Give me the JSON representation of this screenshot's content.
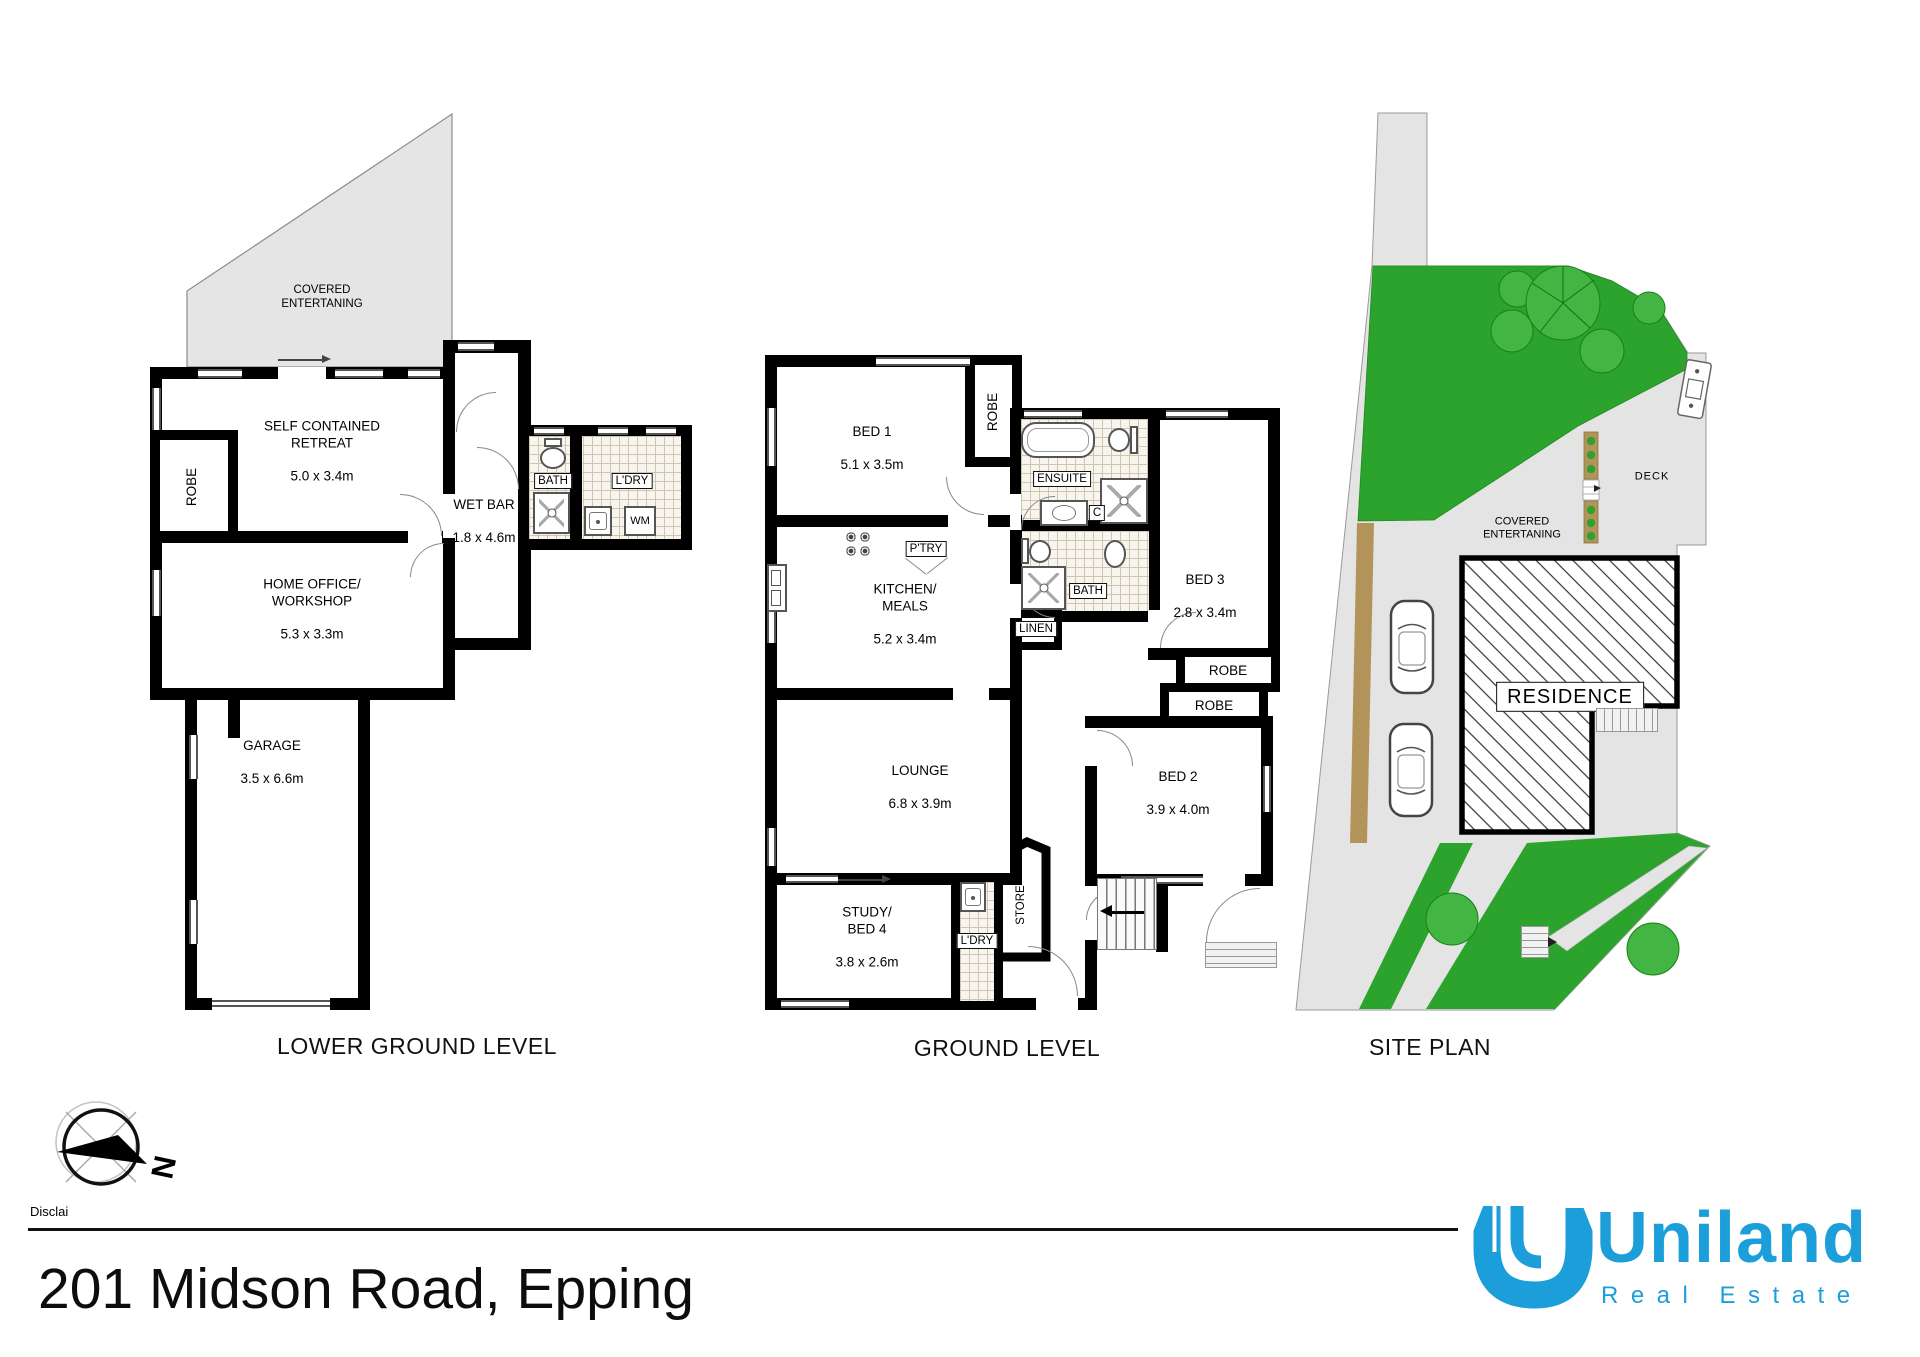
{
  "plans": {
    "lower": {
      "title": "LOWER GROUND LEVEL",
      "covered_entertaining": "COVERED\nENTERTANING",
      "rooms": {
        "retreat": {
          "name": "SELF CONTAINED\nRETREAT",
          "dims": "5.0 x 3.4m"
        },
        "wet_bar": {
          "name": "WET BAR",
          "dims": "1.8 x 4.6m"
        },
        "home_office": {
          "name": "HOME OFFICE/\nWORKSHOP",
          "dims": "5.3 x 3.3m"
        },
        "garage": {
          "name": "GARAGE",
          "dims": "3.5 x 6.6m"
        }
      },
      "labels": {
        "robe": "ROBE",
        "bath": "BATH",
        "laundry": "L'DRY",
        "washing_machine": "WM"
      }
    },
    "ground": {
      "title": "GROUND LEVEL",
      "rooms": {
        "bed1": {
          "name": "BED 1",
          "dims": "5.1 x 3.5m"
        },
        "bed2": {
          "name": "BED 2",
          "dims": "3.9 x 4.0m"
        },
        "bed3": {
          "name": "BED 3",
          "dims": "2.8 x 3.4m"
        },
        "kitchen": {
          "name": "KITCHEN/\nMEALS",
          "dims": "5.2 x 3.4m"
        },
        "lounge": {
          "name": "LOUNGE",
          "dims": "6.8 x 3.9m"
        },
        "study": {
          "name": "STUDY/\nBED 4",
          "dims": "3.8 x 2.6m"
        }
      },
      "labels": {
        "robe_bed1": "ROBE",
        "ensuite": "ENSUITE",
        "cupboard": "C",
        "pantry": "P'TRY",
        "bath": "BATH",
        "linen": "LINEN",
        "robe_bed3": "ROBE",
        "robe_bed2": "ROBE",
        "laundry": "L'DRY",
        "store": "STORE"
      }
    },
    "site": {
      "title": "SITE PLAN",
      "labels": {
        "covered_entertaining": "COVERED\nENTERTANING",
        "deck": "DECK",
        "residence": "RESIDENCE"
      }
    }
  },
  "compass": {
    "north": "N"
  },
  "footer": {
    "disclaimer": "Disclai",
    "address": "201 Midson Road, Epping"
  },
  "logo": {
    "brand": "Uniland",
    "tagline": "Real Estate"
  },
  "colors": {
    "brand": "#1B9ED9",
    "lawn": "#2CA32C",
    "tree": "#42B542",
    "fence": "#B2945B",
    "paving": "#E4E4E4",
    "tile": "#CFC6B2",
    "wall": "#000000"
  }
}
